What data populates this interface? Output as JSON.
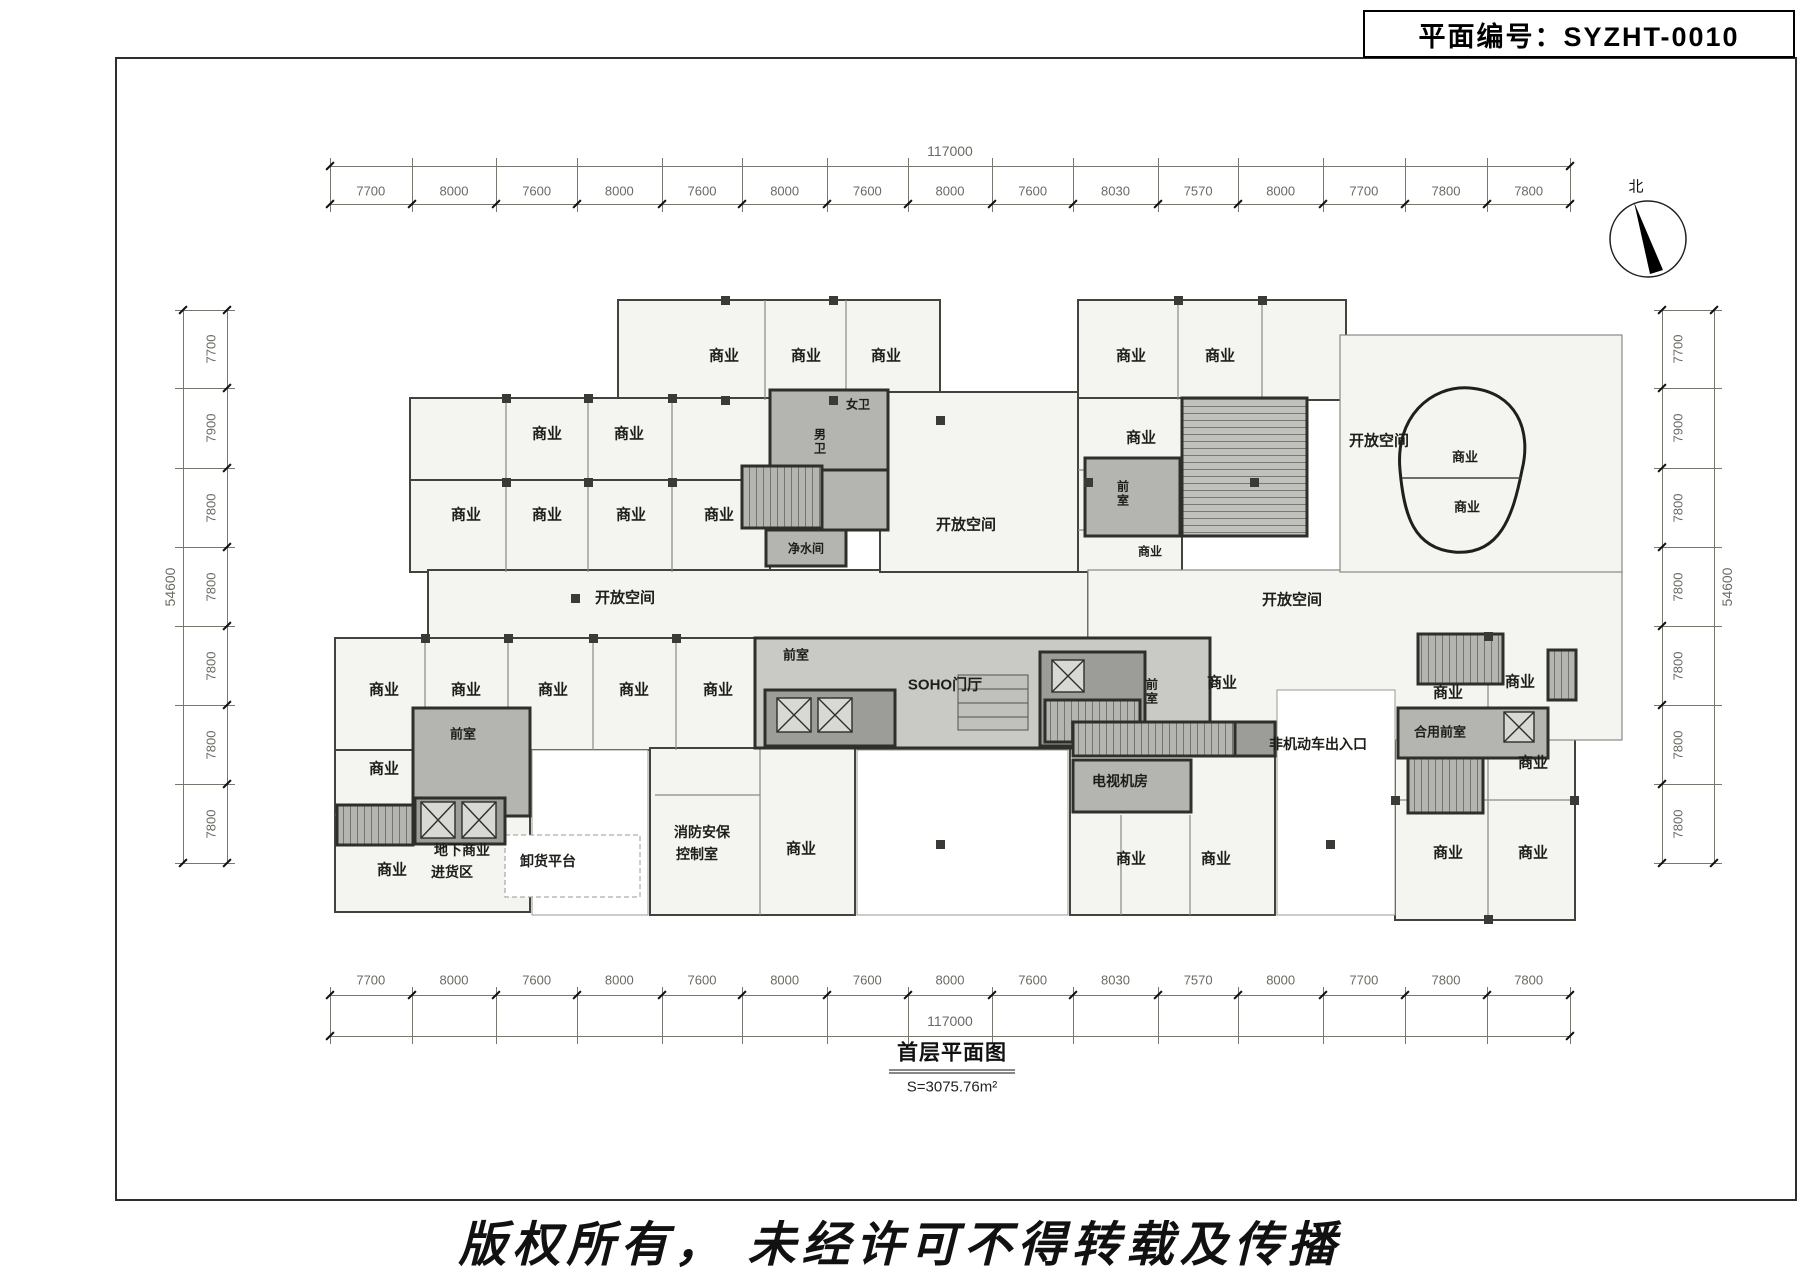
{
  "plan_number_box": {
    "label": "平面编号：SYZHT-0010"
  },
  "north": {
    "label": "北"
  },
  "title_block": {
    "title": "首层平面图",
    "area": "S=3075.76m²"
  },
  "copyright_text": "版权所有， 未经许可不得转载及传播",
  "dimensions": {
    "top": {
      "total": "117000",
      "segments": [
        "7700",
        "8000",
        "7600",
        "8000",
        "7600",
        "8000",
        "7600",
        "8000",
        "7600",
        "8030",
        "7570",
        "8000",
        "7700",
        "7800",
        "7800"
      ]
    },
    "bottom": {
      "total": "117000",
      "segments": [
        "7700",
        "8000",
        "7600",
        "8000",
        "7600",
        "8000",
        "7600",
        "8000",
        "7600",
        "8030",
        "7570",
        "8000",
        "7700",
        "7800",
        "7800"
      ]
    },
    "left": {
      "total": "54600",
      "segments": [
        "7700",
        "7900",
        "7800",
        "7800",
        "7800",
        "7800",
        "7800"
      ]
    },
    "right": {
      "total": "54600",
      "segments": [
        "7700",
        "7900",
        "7800",
        "7800",
        "7800",
        "7800",
        "7800"
      ]
    }
  },
  "plan_labels": [
    {
      "t": "商业",
      "x": 724,
      "y": 355
    },
    {
      "t": "商业",
      "x": 806,
      "y": 355
    },
    {
      "t": "商业",
      "x": 886,
      "y": 355
    },
    {
      "t": "商业",
      "x": 547,
      "y": 433
    },
    {
      "t": "商业",
      "x": 629,
      "y": 433
    },
    {
      "t": "商业",
      "x": 466,
      "y": 514
    },
    {
      "t": "商业",
      "x": 547,
      "y": 514
    },
    {
      "t": "商业",
      "x": 631,
      "y": 514
    },
    {
      "t": "商业",
      "x": 719,
      "y": 514
    },
    {
      "t": "女卫",
      "x": 858,
      "y": 404,
      "s": 12
    },
    {
      "t": "男卫",
      "x": 820,
      "y": 442,
      "s": 12,
      "v": true
    },
    {
      "t": "净水间",
      "x": 806,
      "y": 548,
      "s": 12
    },
    {
      "t": "开放空间",
      "x": 625,
      "y": 597
    },
    {
      "t": "开放空间",
      "x": 966,
      "y": 524
    },
    {
      "t": "商业",
      "x": 1131,
      "y": 355
    },
    {
      "t": "商业",
      "x": 1220,
      "y": 355
    },
    {
      "t": "商业",
      "x": 1141,
      "y": 437
    },
    {
      "t": "前室",
      "x": 1123,
      "y": 494,
      "s": 12,
      "v": true
    },
    {
      "t": "商业",
      "x": 1150,
      "y": 551,
      "s": 12
    },
    {
      "t": "开放空间",
      "x": 1379,
      "y": 440
    },
    {
      "t": "商业",
      "x": 1465,
      "y": 456,
      "s": 13
    },
    {
      "t": "商业",
      "x": 1467,
      "y": 506,
      "s": 13
    },
    {
      "t": "开放空间",
      "x": 1292,
      "y": 599
    },
    {
      "t": "商业",
      "x": 384,
      "y": 689
    },
    {
      "t": "商业",
      "x": 466,
      "y": 689
    },
    {
      "t": "商业",
      "x": 553,
      "y": 689
    },
    {
      "t": "商业",
      "x": 634,
      "y": 689
    },
    {
      "t": "商业",
      "x": 718,
      "y": 689
    },
    {
      "t": "前室",
      "x": 796,
      "y": 654,
      "s": 13
    },
    {
      "t": "SOHO门厅",
      "x": 945,
      "y": 684
    },
    {
      "t": "前室",
      "x": 1152,
      "y": 692,
      "s": 12,
      "v": true
    },
    {
      "t": "商业",
      "x": 1222,
      "y": 682
    },
    {
      "t": "商业",
      "x": 1448,
      "y": 692
    },
    {
      "t": "商业",
      "x": 1520,
      "y": 681
    },
    {
      "t": "合用前室",
      "x": 1440,
      "y": 731,
      "s": 13
    },
    {
      "t": "商业",
      "x": 1533,
      "y": 762
    },
    {
      "t": "商业",
      "x": 384,
      "y": 768
    },
    {
      "t": "前室",
      "x": 463,
      "y": 733,
      "s": 13
    },
    {
      "t": "商业",
      "x": 392,
      "y": 869
    },
    {
      "t": "地下商业",
      "x": 462,
      "y": 850,
      "s": 14
    },
    {
      "t": "进货区",
      "x": 452,
      "y": 872,
      "s": 14
    },
    {
      "t": "卸货平台",
      "x": 548,
      "y": 861,
      "s": 14
    },
    {
      "t": "消防安保",
      "x": 702,
      "y": 832,
      "s": 14
    },
    {
      "t": "控制室",
      "x": 697,
      "y": 854,
      "s": 14
    },
    {
      "t": "商业",
      "x": 801,
      "y": 848
    },
    {
      "t": "电视机房",
      "x": 1120,
      "y": 781,
      "s": 14
    },
    {
      "t": "商业",
      "x": 1131,
      "y": 858
    },
    {
      "t": "商业",
      "x": 1216,
      "y": 858
    },
    {
      "t": "非机动车出入口",
      "x": 1318,
      "y": 744,
      "s": 14
    },
    {
      "t": "商业",
      "x": 1448,
      "y": 852
    },
    {
      "t": "商业",
      "x": 1533,
      "y": 852
    }
  ]
}
